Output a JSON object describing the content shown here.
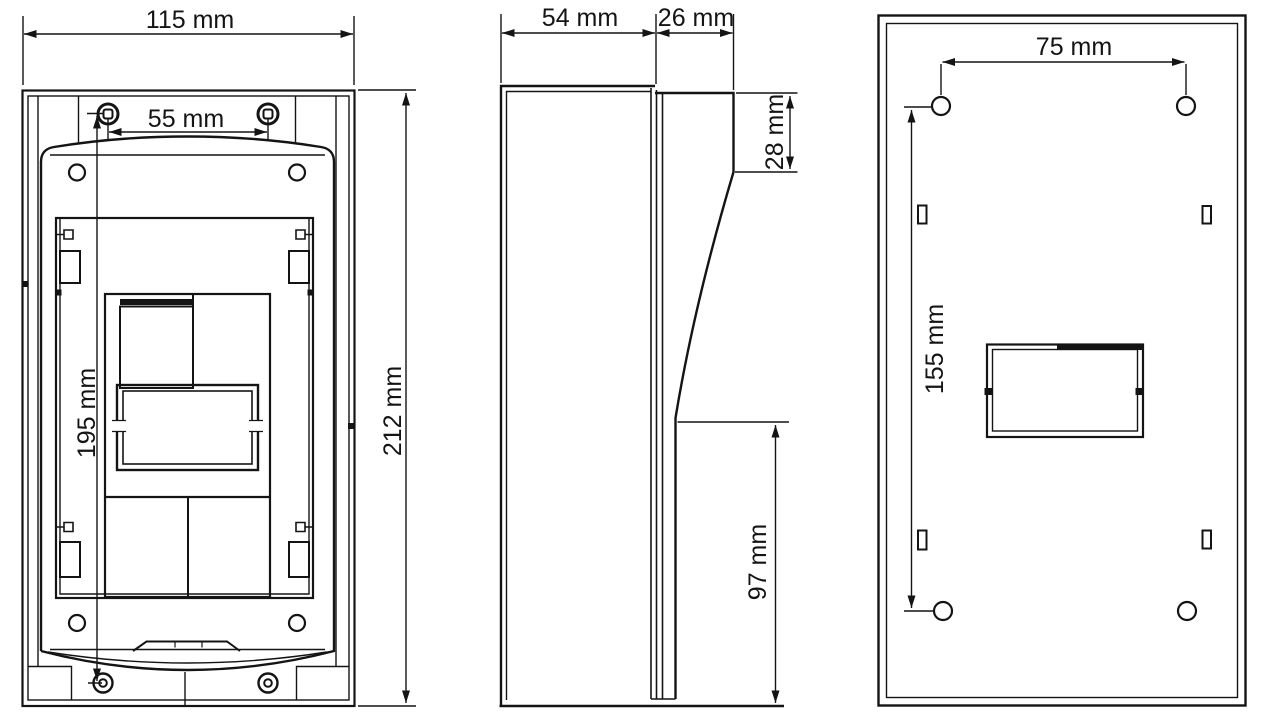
{
  "drawing": {
    "views": {
      "front": {
        "dimensions": {
          "overall_width": "115 mm",
          "top_screw_spacing": "55 mm",
          "screw_vertical_spacing": "195 mm",
          "overall_height": "212 mm"
        }
      },
      "side": {
        "dimensions": {
          "body_depth": "54 mm",
          "hood_depth": "26 mm",
          "hood_edge_height": "28 mm",
          "lower_open_height": "97 mm"
        }
      },
      "back": {
        "dimensions": {
          "mount_hole_spacing_horizontal": "75 mm",
          "mount_hole_spacing_vertical": "155 mm"
        }
      }
    },
    "colors": {
      "line": "#141414",
      "background": "#ffffff"
    }
  }
}
